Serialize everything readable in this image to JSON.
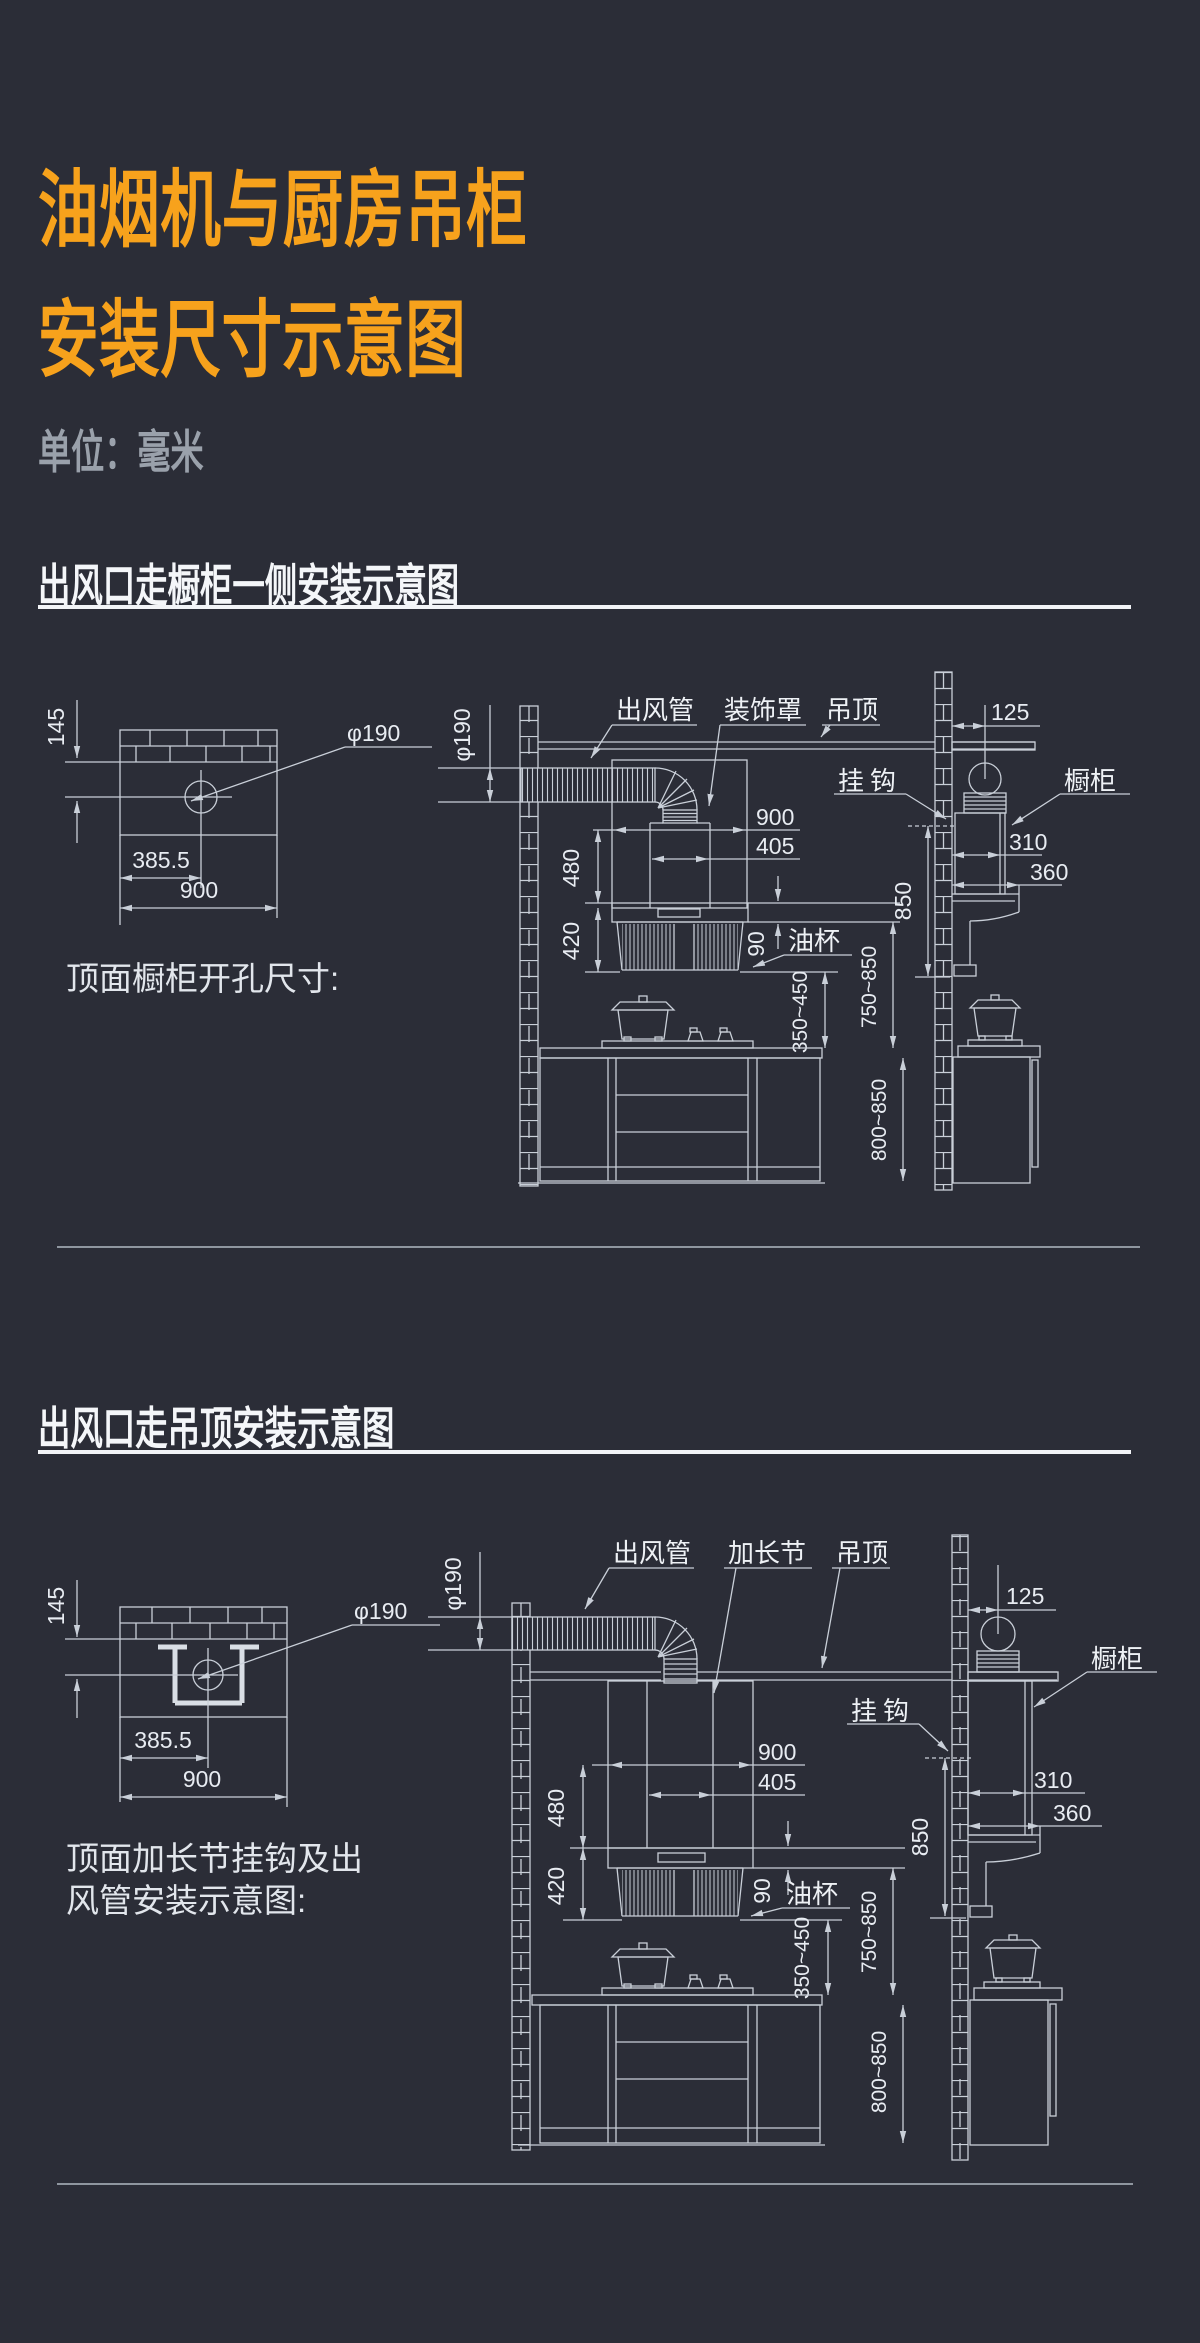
{
  "page": {
    "title_line1": "油烟机与厨房吊柜",
    "title_line2": "安装尺寸示意图",
    "unit_label": "单位：毫米"
  },
  "section1": {
    "heading": "出风口走橱柜一侧安装示意图",
    "caption": "顶面橱柜开孔尺寸:",
    "hole_view": {
      "wall_offset": "145",
      "diameter": "φ190",
      "center_offset": "385.5",
      "width": "900"
    },
    "front_view": {
      "duct_label": "出风管",
      "cover_label": "装饰罩",
      "ceiling_label": "吊顶",
      "oil_cup_label": "油杯",
      "duct_dia": "φ190",
      "hood_width": "900",
      "chimney_width": "405",
      "upper_height": "480",
      "hood_height": "420",
      "canopy_height": "90",
      "min_clearance": "350~450",
      "hood_clearance": "750~850",
      "counter_height": "800~850"
    },
    "side_view": {
      "hook_label": "挂钩",
      "cabinet_label": "橱柜",
      "wall_gap": "125",
      "cabinet_depth": "310",
      "hood_depth": "360",
      "hook_height": "850"
    }
  },
  "section2": {
    "heading": "出风口走吊顶安装示意图",
    "caption_line1": "顶面加长节挂钩及出",
    "caption_line2": "风管安装示意图:",
    "hole_view": {
      "wall_offset": "145",
      "diameter": "φ190",
      "center_offset": "385.5",
      "width": "900"
    },
    "front_view": {
      "duct_label": "出风管",
      "extension_label": "加长节",
      "ceiling_label": "吊顶",
      "oil_cup_label": "油杯",
      "duct_dia": "φ190",
      "hood_width": "900",
      "chimney_width": "405",
      "upper_height": "480",
      "hood_height": "420",
      "canopy_height": "90",
      "min_clearance": "350~450",
      "hood_clearance": "750~850",
      "counter_height": "800~850"
    },
    "side_view": {
      "hook_label": "挂钩",
      "cabinet_label": "橱柜",
      "wall_gap": "125",
      "cabinet_depth": "310",
      "hood_depth": "360",
      "hook_height": "850"
    }
  }
}
